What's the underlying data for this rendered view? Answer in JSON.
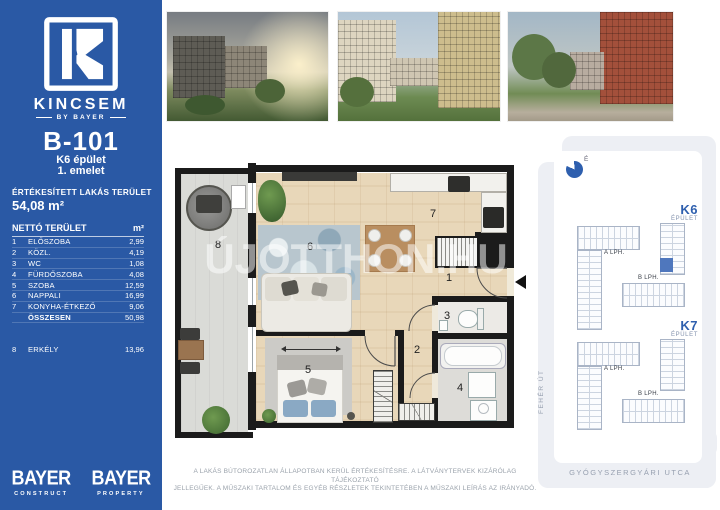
{
  "sidebar": {
    "brand": "KINCSEM",
    "brand_sub": "BY BAYER",
    "unit_id": "B-101",
    "building": "K6 épület",
    "floor": "1. emelet",
    "sold_area_label": "ÉRTÉKESÍTETT LAKÁS TERÜLET",
    "sold_area_value": "54,08 m²",
    "table": {
      "header": "NETTÓ TERÜLET",
      "unit_header": "m²",
      "rows": [
        {
          "num": "1",
          "name": "ELŐSZOBA",
          "value": "2,99"
        },
        {
          "num": "2",
          "name": "KÖZL.",
          "value": "4,19"
        },
        {
          "num": "3",
          "name": "WC",
          "value": "1,08"
        },
        {
          "num": "4",
          "name": "FÜRDŐSZOBA",
          "value": "4,08"
        },
        {
          "num": "5",
          "name": "SZOBA",
          "value": "12,59"
        },
        {
          "num": "6",
          "name": "NAPPALI",
          "value": "16,99"
        },
        {
          "num": "7",
          "name": "KONYHA-ÉTKEZŐ",
          "value": "9,06"
        },
        {
          "num": "",
          "name": "ÖSSZESEN",
          "value": "50,98"
        },
        {
          "num": "8",
          "name": "ERKÉLY",
          "value": "13,96"
        }
      ]
    },
    "logos": [
      {
        "name": "BAYER",
        "sub": "CONSTRUCT"
      },
      {
        "name": "BAYER",
        "sub": "PROPERTY"
      }
    ]
  },
  "plan": {
    "watermark": "ÚJOTTHON.HU",
    "rooms": {
      "hall": "1",
      "corridor": "2",
      "wc": "3",
      "bath": "4",
      "bedroom": "5",
      "living": "6",
      "kitchen": "7",
      "balcony": "8"
    }
  },
  "map": {
    "compass": "É",
    "buildings": [
      {
        "id": "K6",
        "label": "ÉPÜLET",
        "a": "A LPH.",
        "b": "B LPH."
      },
      {
        "id": "K7",
        "label": "ÉPÜLET",
        "a": "A LPH.",
        "b": "B LPH."
      }
    ],
    "street_left": "FEHÉR ÚT",
    "street_bottom": "GYÓGYSZERGYÁRI UTCA"
  },
  "disclaimer": {
    "line1": "A LAKÁS BÚTOROZATLAN ÁLLAPOTBAN KERÜL ÉRTÉKESÍTÉSRE. A LÁTVÁNYTERVEK KIZÁRÓLAG TÁJÉKOZTATÓ",
    "line2": "JELLEGŰEK. A MŰSZAKI TARTALOM ÉS EGYÉB RÉSZLETEK TEKINTETÉBEN A MŰSZAKI LEÍRÁS AZ IRÁNYADÓ."
  },
  "colors": {
    "brand_blue": "#2a59a5",
    "accent_blue": "#2e5fae",
    "wall": "#1b1b1b"
  }
}
